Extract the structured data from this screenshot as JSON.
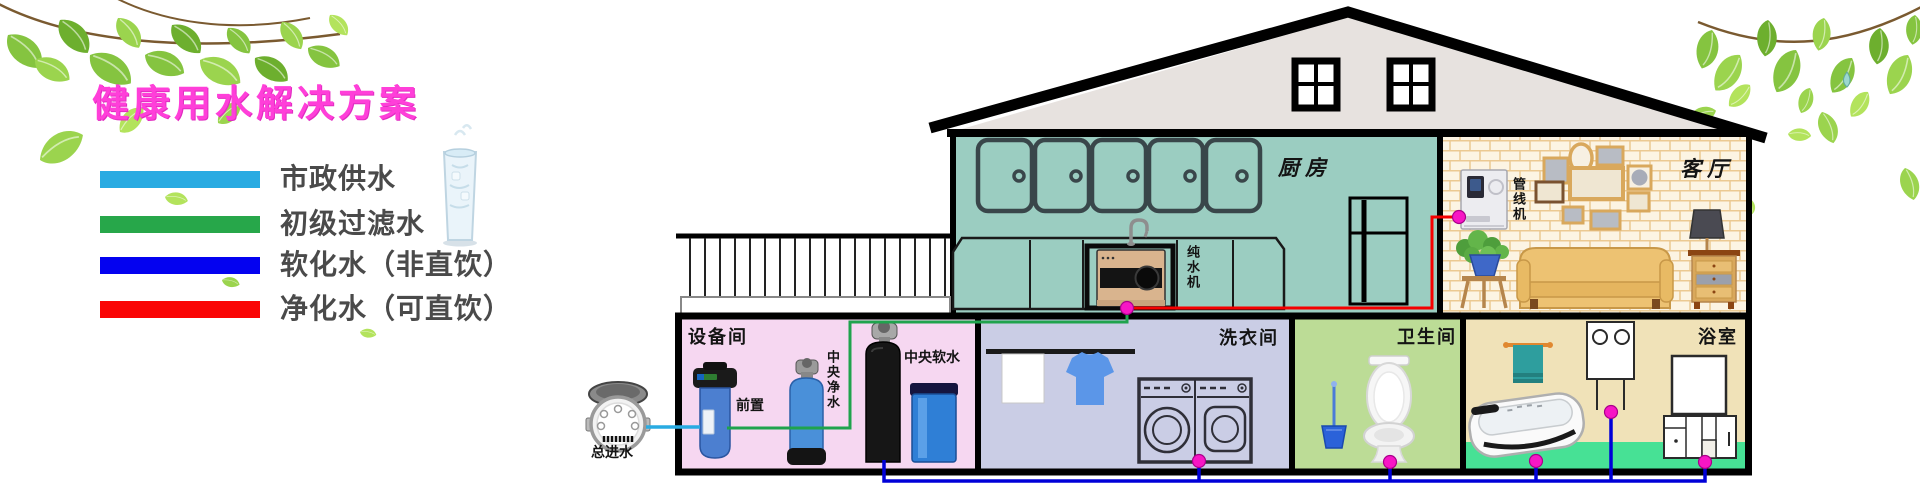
{
  "banner": {
    "title": "健康用水解决方案",
    "title_color": "#FF3FD9"
  },
  "legend": {
    "items": [
      {
        "label": "市政供水",
        "color": "#29ABE2"
      },
      {
        "label": "初级过滤水",
        "color": "#27A74A"
      },
      {
        "label": "软化水（非直饮）",
        "color": "#0402F0"
      },
      {
        "label": "净化水（可直饮）",
        "color": "#FA0505"
      }
    ]
  },
  "rooms": {
    "kitchen": "厨房",
    "living_room": "客厅",
    "equipment_room": "设备间",
    "laundry_room": "洗衣间",
    "toilet_room": "卫生间",
    "bathroom": "浴室"
  },
  "equipment": {
    "main_inlet": "总进水",
    "prefilter": "前置",
    "central_purifier": "中央净水",
    "central_softener": "中央软水",
    "pure_water_machine": "纯水机",
    "pipeline_machine": "管线机"
  },
  "pipe_colors": {
    "municipal_water": "#29ABE2",
    "primary_filtered_water": "#1FA34D",
    "softened_water": "#0000D8",
    "purified_water": "#F50000",
    "joint_dot": "#F716C5"
  },
  "room_colors": {
    "kitchen": "#9BCDC1",
    "equipment_room": "#F6D7F1",
    "laundry_room": "#CACDE5",
    "toilet_room": "#BCDC96",
    "bathroom": "#F0E2B8",
    "bathroom_floor": "#47E195",
    "living_wall": "#FCF4E3",
    "gable": "#E7E2DF"
  }
}
